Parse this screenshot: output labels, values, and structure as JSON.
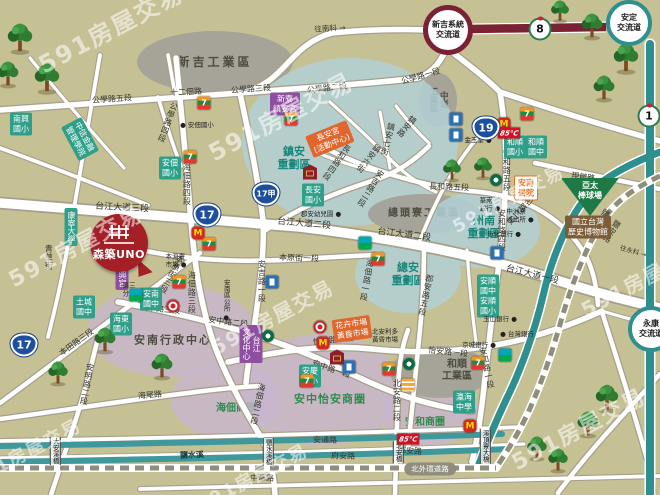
{
  "watermark": {
    "text": "591房屋交易",
    "spots": [
      {
        "x": 110,
        "y": 27,
        "s": 24
      },
      {
        "x": 280,
        "y": 115,
        "s": 24
      },
      {
        "x": 75,
        "y": 245,
        "s": 22
      },
      {
        "x": 272,
        "y": 316,
        "s": 20
      },
      {
        "x": 252,
        "y": 477,
        "s": 18
      },
      {
        "x": 578,
        "y": 428,
        "s": 22
      },
      {
        "x": 642,
        "y": 278,
        "s": 20
      },
      {
        "x": 25,
        "y": 452,
        "s": 18
      },
      {
        "x": 508,
        "y": 198,
        "s": 18
      }
    ]
  },
  "balloon": {
    "title": "森築UNO"
  },
  "pill": {
    "text": "北外環道路"
  },
  "palette": {
    "land": "#c6c195",
    "teal_road": "#2f8e8e",
    "maroon_highway": "#7a2233",
    "river": "#3f989b",
    "school_box": "#2f9f8a",
    "temple_box": "#8e4fa0",
    "market_box": "#e0662d",
    "balloon_red": "#a51f26",
    "museum_box": "#7d5d38",
    "field_green": "#1e7a44"
  },
  "regions": [
    {
      "t": "新吉工業區",
      "x": 215,
      "y": 62,
      "rx": 78,
      "ry": 31,
      "kind": "ind",
      "fs": 12,
      "ls": 3
    },
    {
      "t": "中崙\n工業區",
      "x": 438,
      "y": 100,
      "rx": 19,
      "ry": 27,
      "kind": "ind",
      "lv": 1,
      "fs": 8.5
    },
    {
      "t": "鎮安\n重劃區",
      "x": 350,
      "y": 142,
      "rx": 108,
      "ry": 84,
      "kind": "blue",
      "lx": 294,
      "ly": 158,
      "lc": "teal",
      "fs": 11
    },
    {
      "t": "總頭寮工業區",
      "x": 424,
      "y": 214,
      "rx": 56,
      "ry": 20,
      "kind": "ind",
      "fs": 10,
      "ls": 2
    },
    {
      "t": "總安\n重劃區",
      "x": 408,
      "y": 274,
      "rx": 53,
      "ry": 39,
      "kind": "blue",
      "lc": "teal",
      "fs": 11
    },
    {
      "t": "州南\n重劃區",
      "x": 483,
      "y": 229,
      "rx": 57,
      "ry": 39,
      "kind": "blue",
      "lx": 484,
      "ly": 227,
      "lc": "teal",
      "fs": 11
    },
    {
      "t": "安南行政中心",
      "x": 172,
      "y": 331,
      "rx": 84,
      "ry": 46,
      "kind": "pur",
      "lx": 173,
      "ly": 340,
      "lc": "dark",
      "fs": 11,
      "ls": 2
    },
    {
      "t": "海佃商圈",
      "x": 227,
      "y": 400,
      "rx": 56,
      "ry": 38,
      "kind": "pur",
      "lx": 236,
      "ly": 409,
      "lc": "green",
      "fs": 10
    },
    {
      "t": "安中怡安商圈",
      "x": 322,
      "y": 390,
      "rx": 80,
      "ry": 56,
      "kind": "pur",
      "lx": 330,
      "ly": 399,
      "lc": "green",
      "fs": 11,
      "ls": 1
    },
    {
      "t": "安和商圈",
      "x": 430,
      "y": 412,
      "rx": 48,
      "ry": 34,
      "kind": "pur",
      "lx": 425,
      "ly": 423,
      "lc": "green",
      "fs": 10
    },
    {
      "t": "和順\n工業區",
      "x": 440,
      "y": 372,
      "rx": 50,
      "ry": 26,
      "kind": "ind",
      "lx": 457,
      "ly": 371,
      "fs": 10
    }
  ],
  "road_labels": [
    {
      "t": "往南科 →",
      "x": 330,
      "y": 29,
      "r": -3,
      "fs": 7.5
    },
    {
      "t": "公學路五段",
      "x": 112,
      "y": 100,
      "r": -4
    },
    {
      "t": "十二佃路",
      "x": 186,
      "y": 93,
      "r": -3
    },
    {
      "t": "公學路四段",
      "x": 167,
      "y": 122,
      "v": 1,
      "r": 20
    },
    {
      "t": "公學路三段",
      "x": 251,
      "y": 90,
      "r": -4
    },
    {
      "t": "公學路二段",
      "x": 327,
      "y": 89,
      "r": -7
    },
    {
      "t": "公學路一段",
      "x": 421,
      "y": 77,
      "r": -16
    },
    {
      "t": "台江大道三段",
      "x": 122,
      "y": 209,
      "r": 3,
      "fs": 9
    },
    {
      "t": "台江大道二段",
      "x": 304,
      "y": 225,
      "r": 5,
      "fs": 9
    },
    {
      "t": "台江大道二段",
      "x": 404,
      "y": 236,
      "r": 7,
      "fs": 9
    },
    {
      "t": "台江大道一段",
      "x": 532,
      "y": 276,
      "r": 14,
      "fs": 9
    },
    {
      "t": "海佃路四段",
      "x": 186,
      "y": 184,
      "v": 1
    },
    {
      "t": "海佃路三段",
      "x": 191,
      "y": 292,
      "v": 1
    },
    {
      "t": "海佃路二段",
      "x": 257,
      "y": 404,
      "v": 1,
      "r": 12
    },
    {
      "t": "海佃路一段",
      "x": 366,
      "y": 280,
      "v": 1,
      "r": 10
    },
    {
      "t": "安吉路一段",
      "x": 261,
      "y": 281,
      "v": 1
    },
    {
      "t": "安吉路二段",
      "x": 370,
      "y": 188,
      "v": 1,
      "r": 32
    },
    {
      "t": "郡安路五段",
      "x": 425,
      "y": 295,
      "v": 1,
      "r": 12
    },
    {
      "t": "北安路二段",
      "x": 396,
      "y": 400,
      "v": 1
    },
    {
      "t": "安和路五段",
      "x": 506,
      "y": 170,
      "v": 1
    },
    {
      "t": "安和路四段",
      "x": 501,
      "y": 230,
      "v": 1
    },
    {
      "t": "安和路一段",
      "x": 486,
      "y": 368,
      "v": 1,
      "r": -12
    },
    {
      "t": "安明路二段",
      "x": 86,
      "y": 384,
      "v": 1,
      "r": 10
    },
    {
      "t": "本田路三段",
      "x": 77,
      "y": 343,
      "r": -36
    },
    {
      "t": "本原街三段",
      "x": 171,
      "y": 274,
      "v": 1,
      "r": 28
    },
    {
      "t": "本原街一段",
      "x": 299,
      "y": 259,
      "r": 2
    },
    {
      "t": "安中路三段",
      "x": 160,
      "y": 310,
      "r": 5
    },
    {
      "t": "安中路二段",
      "x": 228,
      "y": 323,
      "r": 7
    },
    {
      "t": "安中路一段",
      "x": 331,
      "y": 370,
      "r": 19
    },
    {
      "t": "怡安路二段",
      "x": 333,
      "y": 341,
      "r": -6
    },
    {
      "t": "怡安路一段",
      "x": 448,
      "y": 353,
      "r": 6
    },
    {
      "t": "海尾路",
      "x": 150,
      "y": 396,
      "r": -5
    },
    {
      "t": "青草街",
      "x": 48,
      "y": 257,
      "v": 1
    },
    {
      "t": "長和路四段",
      "x": 336,
      "y": 162,
      "v": 1,
      "r": 35
    },
    {
      "t": "長和路五段",
      "x": 449,
      "y": 188,
      "r": 2
    },
    {
      "t": "長和路二段",
      "x": 522,
      "y": 207,
      "v": 1,
      "r": 42
    },
    {
      "t": "鎮安六街",
      "x": 368,
      "y": 158,
      "v": 1,
      "r": 38
    },
    {
      "t": "鎮安七街",
      "x": 387,
      "y": 139,
      "v": 1,
      "r": 14
    },
    {
      "t": "鎮安路",
      "x": 406,
      "y": 126,
      "v": 1,
      "r": 40
    },
    {
      "t": "現館路",
      "x": 583,
      "y": 178,
      "r": 8
    },
    {
      "t": "鹽和路",
      "x": 600,
      "y": 220,
      "v": 1,
      "r": 33
    },
    {
      "t": "鹽安路",
      "x": 611,
      "y": 231,
      "v": 1,
      "r": 33
    },
    {
      "t": "往永科 →",
      "x": 633,
      "y": 252,
      "r": 16,
      "fs": 6.5
    },
    {
      "t": "安通路",
      "x": 325,
      "y": 441,
      "r": 1
    },
    {
      "t": "府安路",
      "x": 343,
      "y": 457,
      "r": 1
    },
    {
      "t": "郡安路",
      "x": 410,
      "y": 452,
      "r": 3
    },
    {
      "t": "中華路",
      "x": 262,
      "y": 479,
      "r": 1
    },
    {
      "t": "鹽水溪",
      "x": 192,
      "y": 456,
      "r": -2,
      "fs": 8,
      "cls": "river"
    }
  ],
  "boxes": [
    {
      "t": "南興\n國小",
      "x": 21,
      "y": 124,
      "k": "b-school"
    },
    {
      "t": "中信金融\n管理學院",
      "x": 80,
      "y": 139,
      "k": "b-school",
      "r": 62
    },
    {
      "t": "安佃\n國小",
      "x": 170,
      "y": 168,
      "k": "b-school"
    },
    {
      "t": "康寧大學",
      "x": 71,
      "y": 227,
      "k": "b-school",
      "v": 1
    },
    {
      "t": "土城\n國中",
      "x": 84,
      "y": 307,
      "k": "b-school"
    },
    {
      "t": "海東\n國小",
      "x": 121,
      "y": 324,
      "k": "b-school"
    },
    {
      "t": "安南\n國中",
      "x": 151,
      "y": 299,
      "k": "b-school"
    },
    {
      "t": "長安\n國小",
      "x": 313,
      "y": 195,
      "k": "b-school"
    },
    {
      "t": "安慶\n國小",
      "x": 310,
      "y": 376,
      "k": "b-school"
    },
    {
      "t": "安順\n國中",
      "x": 488,
      "y": 286,
      "k": "b-school"
    },
    {
      "t": "安順\n國小",
      "x": 488,
      "y": 306,
      "k": "b-school"
    },
    {
      "t": "和順\n國小",
      "x": 515,
      "y": 147,
      "k": "b-school"
    },
    {
      "t": "和順\n國中",
      "x": 536,
      "y": 147,
      "k": "b-school"
    },
    {
      "t": "瀛海\n中學",
      "x": 464,
      "y": 402,
      "k": "b-school"
    },
    {
      "t": "新寮\n鎮安宮",
      "x": 285,
      "y": 104,
      "k": "b-purple"
    },
    {
      "t": "朝興宮",
      "x": 122,
      "y": 275,
      "k": "b-purple",
      "v": 1
    },
    {
      "t": "台江\n文化中心",
      "x": 251,
      "y": 344,
      "k": "b-purple",
      "v": 1
    },
    {
      "t": "長安宮\n(活動中心)",
      "x": 330,
      "y": 139,
      "k": "b-orange",
      "r": -22
    },
    {
      "t": "花卉市場\n黃昏市場",
      "x": 352,
      "y": 329,
      "k": "b-orange",
      "r": -8
    },
    {
      "t": "安南\n醫院",
      "x": 526,
      "y": 188,
      "k": "b-hospital"
    },
    {
      "t": "國立台灣\n歷史博物館",
      "x": 588,
      "y": 227,
      "k": "b-museum"
    }
  ],
  "field": {
    "t": "亞太\n棒球場",
    "x": 590,
    "y": 197
  },
  "dots": [
    {
      "t": "● 安佃國小",
      "x": 197,
      "y": 125
    },
    {
      "t": "金玉堂 ●",
      "x": 478,
      "y": 140
    },
    {
      "t": "華南\n銀行 ●",
      "x": 490,
      "y": 205
    },
    {
      "t": "中洲寮\n派出所 ●",
      "x": 520,
      "y": 216
    },
    {
      "t": "彰化銀行 ●",
      "x": 504,
      "y": 234
    },
    {
      "t": "玉山銀行 ●",
      "x": 500,
      "y": 319
    },
    {
      "t": "● 台灣銀行",
      "x": 517,
      "y": 334
    },
    {
      "t": "京城銀行 ●",
      "x": 479,
      "y": 345
    },
    {
      "t": "本淵寮\n市場 ●",
      "x": 176,
      "y": 261
    },
    {
      "t": "安南區公所 ●",
      "x": 226,
      "y": 300,
      "v": 1
    },
    {
      "t": "郡安幼兒園 ●",
      "x": 321,
      "y": 214
    },
    {
      "t": "北安利多\n黃昏市場",
      "x": 385,
      "y": 336
    },
    {
      "t": "第三\n分局 ●",
      "x": 133,
      "y": 290
    }
  ],
  "bridges": [
    {
      "t": "大安溪橋",
      "x": 55,
      "y": 451
    },
    {
      "t": "鹽水溪橋",
      "x": 268,
      "y": 452
    },
    {
      "t": "北安橋",
      "x": 398,
      "y": 452
    },
    {
      "t": "溪頂寮大橋",
      "x": 485,
      "y": 446
    }
  ],
  "shields": [
    {
      "k": "blue",
      "t": "17",
      "x": 207,
      "y": 215
    },
    {
      "k": "blue",
      "t": "17甲",
      "x": 266,
      "y": 194
    },
    {
      "k": "blue",
      "t": "19",
      "x": 486,
      "y": 128
    },
    {
      "k": "blue",
      "t": "17",
      "x": 24,
      "y": 345
    },
    {
      "k": "flower",
      "t": "8",
      "x": 540,
      "y": 29
    },
    {
      "k": "flower",
      "t": "1",
      "x": 649,
      "y": 116
    }
  ],
  "interchanges": [
    {
      "t": "新吉系統\n交流道",
      "x": 448,
      "y": 30,
      "ring": "maroon",
      "s": 50
    },
    {
      "t": "安定\n交流道",
      "x": 629,
      "y": 23,
      "ring": "teal",
      "s": 46
    },
    {
      "t": "永康\n交流道",
      "x": 651,
      "y": 329,
      "ring": "teal",
      "s": 46
    }
  ],
  "icons": [
    {
      "k": "seven",
      "x": 204,
      "y": 103
    },
    {
      "k": "seven",
      "x": 190,
      "y": 157
    },
    {
      "k": "seven",
      "x": 291,
      "y": 119
    },
    {
      "k": "seven",
      "x": 527,
      "y": 114
    },
    {
      "k": "seven",
      "x": 209,
      "y": 244
    },
    {
      "k": "seven",
      "x": 179,
      "y": 282
    },
    {
      "k": "seven",
      "x": 378,
      "y": 259
    },
    {
      "k": "seven",
      "x": 307,
      "y": 381
    },
    {
      "k": "seven",
      "x": 389,
      "y": 369
    },
    {
      "k": "seven",
      "x": 478,
      "y": 363
    },
    {
      "k": "family",
      "x": 365,
      "y": 243
    },
    {
      "k": "family",
      "x": 136,
      "y": 295
    },
    {
      "k": "family",
      "x": 505,
      "y": 355
    },
    {
      "k": "mcd",
      "x": 198,
      "y": 233
    },
    {
      "k": "mcd",
      "x": 323,
      "y": 343
    },
    {
      "k": "mcd",
      "x": 470,
      "y": 426
    },
    {
      "k": "mcd",
      "x": 504,
      "y": 124
    },
    {
      "k": "sbux",
      "x": 268,
      "y": 336
    },
    {
      "k": "sbux",
      "x": 496,
      "y": 180
    },
    {
      "k": "sbux",
      "x": 409,
      "y": 364
    },
    {
      "k": "gas",
      "x": 456,
      "y": 119
    },
    {
      "k": "gas",
      "x": 456,
      "y": 135
    },
    {
      "k": "gas",
      "x": 349,
      "y": 367
    },
    {
      "k": "gas",
      "x": 272,
      "y": 282
    },
    {
      "k": "gas",
      "x": 497,
      "y": 253
    },
    {
      "k": "temple",
      "x": 310,
      "y": 172
    },
    {
      "k": "temple",
      "x": 337,
      "y": 357
    },
    {
      "k": "c85",
      "x": 509,
      "y": 133
    },
    {
      "k": "c85",
      "x": 408,
      "y": 439
    },
    {
      "k": "post",
      "x": 408,
      "y": 385
    },
    {
      "k": "cpc",
      "x": 320,
      "y": 327
    },
    {
      "k": "cpc",
      "x": 173,
      "y": 306
    }
  ],
  "trees": [
    {
      "x": 20,
      "y": 40,
      "s": 30
    },
    {
      "x": 8,
      "y": 76,
      "s": 26
    },
    {
      "x": 47,
      "y": 80,
      "s": 30
    },
    {
      "x": 560,
      "y": 13,
      "s": 22
    },
    {
      "x": 592,
      "y": 28,
      "s": 26
    },
    {
      "x": 626,
      "y": 60,
      "s": 30
    },
    {
      "x": 604,
      "y": 90,
      "s": 26
    },
    {
      "x": 452,
      "y": 172,
      "s": 22
    },
    {
      "x": 483,
      "y": 170,
      "s": 22
    },
    {
      "x": 105,
      "y": 342,
      "s": 26
    },
    {
      "x": 58,
      "y": 375,
      "s": 24
    },
    {
      "x": 162,
      "y": 368,
      "s": 26
    },
    {
      "x": 537,
      "y": 450,
      "s": 24
    },
    {
      "x": 558,
      "y": 462,
      "s": 24
    },
    {
      "x": 588,
      "y": 426,
      "s": 26
    },
    {
      "x": 607,
      "y": 400,
      "s": 28
    }
  ]
}
